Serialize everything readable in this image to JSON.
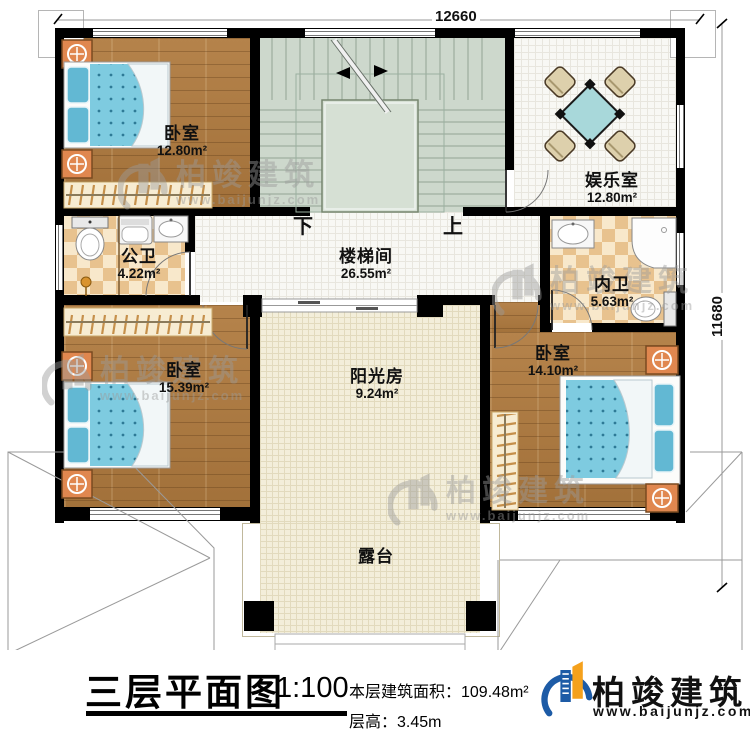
{
  "dimensions": {
    "top": "12660",
    "right": "11680"
  },
  "stairs": {
    "down_label": "下",
    "up_label": "上"
  },
  "rooms": {
    "bedroom_top_left": {
      "name": "卧室",
      "area": "12.80m²"
    },
    "entertainment_room": {
      "name": "娱乐室",
      "area": "12.80m²"
    },
    "public_bathroom": {
      "name": "公卫",
      "area": "4.22m²"
    },
    "stair_hall": {
      "name": "楼梯间",
      "area": "26.55m²"
    },
    "ensuite_bathroom": {
      "name": "内卫",
      "area": "5.63m²"
    },
    "bedroom_bottom_left": {
      "name": "卧室",
      "area": "15.39m²"
    },
    "sunroom": {
      "name": "阳光房",
      "area": "9.24m²"
    },
    "bedroom_bottom_right": {
      "name": "卧室",
      "area": "14.10m²"
    },
    "terrace": {
      "name": "露台"
    }
  },
  "watermark": {
    "brand": "柏竣建筑",
    "url": "www.baijunjz.com"
  },
  "title_block": {
    "title": "三层平面图",
    "scale": "1:100",
    "floor_area": "本层建筑面积：109.48m²",
    "floor_height": "层高：3.45m",
    "brand": "柏竣建筑",
    "brand_url": "www.baijunjz.com"
  },
  "colors": {
    "wall": "#000000",
    "stair_floor": "#cdd8cc",
    "wood_floor": "#ae7a40",
    "checker_dark": "#e8c28e",
    "checker_light": "#f8e8cb",
    "cream_floor": "#f3eeda",
    "bed_blue": "#7ecbe0",
    "furniture_orange": "#e0874f",
    "table_teal": "#a8d8da",
    "logo_blue": "#1d5ba6",
    "logo_orange": "#f5a11c"
  }
}
